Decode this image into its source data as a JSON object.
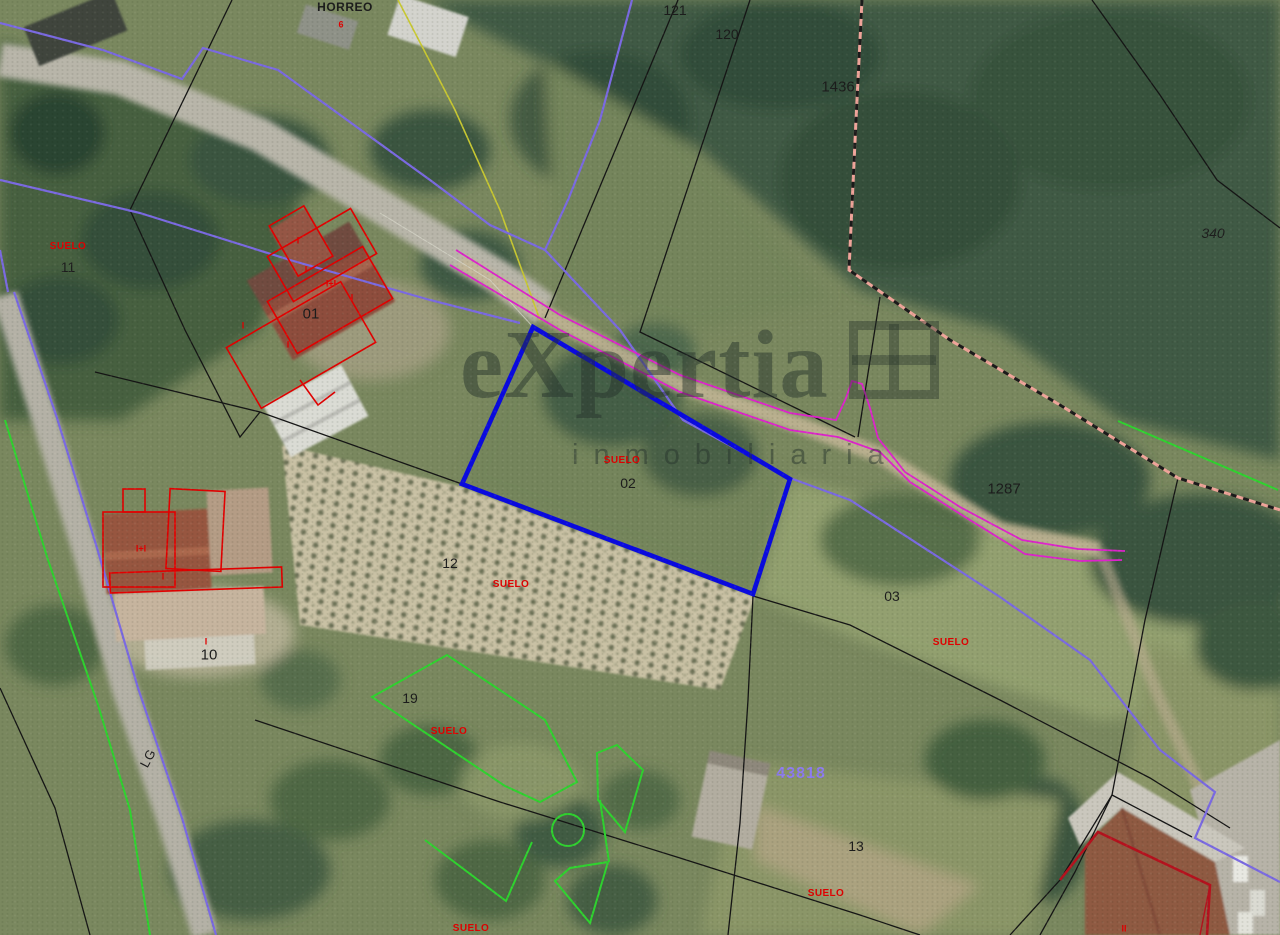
{
  "map": {
    "type": "cadastral-parcel-viewer-aerial",
    "selected_parcel_color": "#0a0ae0",
    "boundary_color": "#151515",
    "road_edge_color": "#7b6ae2",
    "municipal_boundary_color": "#f0a49a",
    "path_color": "#de23cc",
    "vegetation_outline_color": "#2fd32f",
    "building_outline_color": "#e20000",
    "parcel_ref_color": "#1c1c1c",
    "suelo_color": "#e00000",
    "cadastral_ref_color": "#8d7bf0"
  },
  "watermark": {
    "brand": "eXpertia",
    "tagline": "inmobiliaria"
  },
  "labels": {
    "horreo": "HORREO",
    "horreo_mark": "6",
    "p121": "121",
    "p120": "120",
    "p1436": "1436",
    "p340": "340",
    "suelo_11": "SUELO",
    "p11": "11",
    "p01": "01",
    "floor_i_1": "I",
    "floor_i_2": "I",
    "floor_mix_01": "I+I",
    "floor_i_3": "I",
    "floor_i_4": "I",
    "floor_i_5": "I",
    "suelo_02": "SUELO",
    "p02": "02",
    "p12": "12",
    "suelo_12": "SUELO",
    "p1287": "1287",
    "p03": "03",
    "suelo_03": "SUELO",
    "floor_mix_10": "I+I",
    "floor_i_6": "I",
    "mark_10": "I",
    "p10": "10",
    "lg": "LG",
    "p19": "19",
    "suelo_19": "SUELO",
    "p43818": "43818",
    "p13": "13",
    "suelo_13": "SUELO",
    "suelo_south": "SUELO",
    "floor_ii": "II"
  }
}
